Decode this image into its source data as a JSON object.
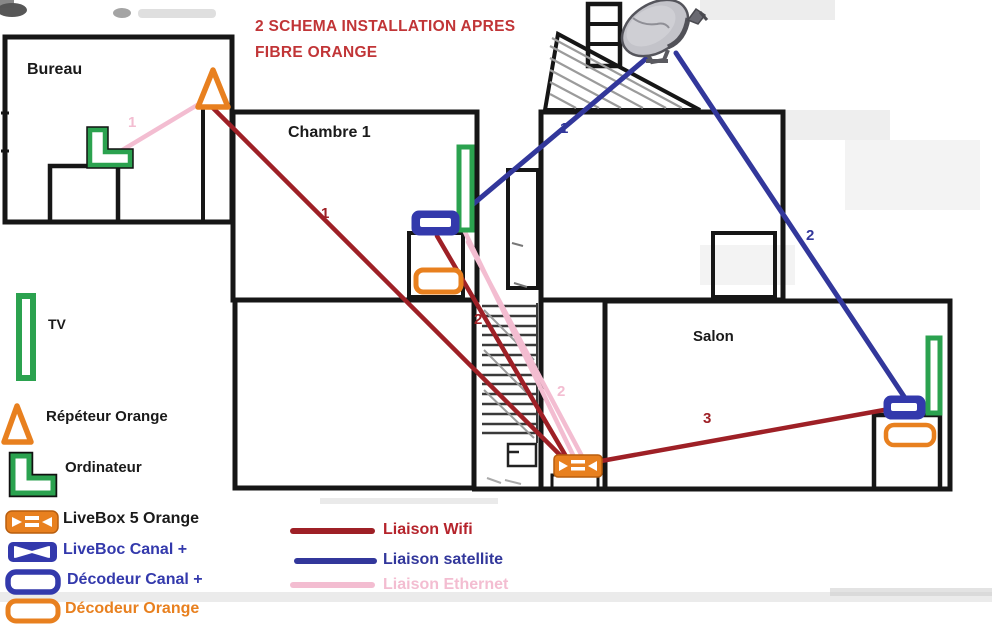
{
  "title": {
    "line1": "2 SCHEMA INSTALLATION APRES",
    "line2": "FIBRE ORANGE"
  },
  "rooms": {
    "bureau": "Bureau",
    "chambre1": "Chambre 1",
    "salon": "Salon"
  },
  "connection_labels": {
    "ethernet_bureau": "1",
    "wifi_repeater_livebox": "1",
    "satellite_chambre": "1",
    "satellite_salon": "2",
    "wifi_decoder_livebox": "2",
    "ethernet_chambre_livebox": "2",
    "wifi_livebox_salon": "3"
  },
  "device_legend": [
    {
      "icon": "tv-icon",
      "label": "TV"
    },
    {
      "icon": "repeater-triangle-icon",
      "label": "Répéteur Orange"
    },
    {
      "icon": "computer-icon",
      "label": "Ordinateur"
    },
    {
      "icon": "livebox-orange-icon",
      "label": "LiveBox 5 Orange"
    },
    {
      "icon": "livebox-canal-icon",
      "label": "LiveBoc Canal +"
    },
    {
      "icon": "decoder-canal-icon",
      "label": "Décodeur Canal +"
    },
    {
      "icon": "decoder-orange-icon",
      "label": "Décodeur Orange"
    }
  ],
  "line_legend": [
    {
      "name": "wifi",
      "label": "Liaison Wifi",
      "color": "#9e2026"
    },
    {
      "name": "satellite",
      "label": "Liaison satellite",
      "color": "#32379b"
    },
    {
      "name": "ethernet",
      "label": "Liaison Ethernet",
      "color": "#f3bdd1"
    }
  ],
  "colors": {
    "wall": "#161616",
    "title": "#c13537",
    "wifi": "#9e2026",
    "satellite": "#32379b",
    "ethernet": "#f3bdd1",
    "orange": "#e8801f",
    "green": "#2ba24f",
    "canal": "#3339ac"
  }
}
